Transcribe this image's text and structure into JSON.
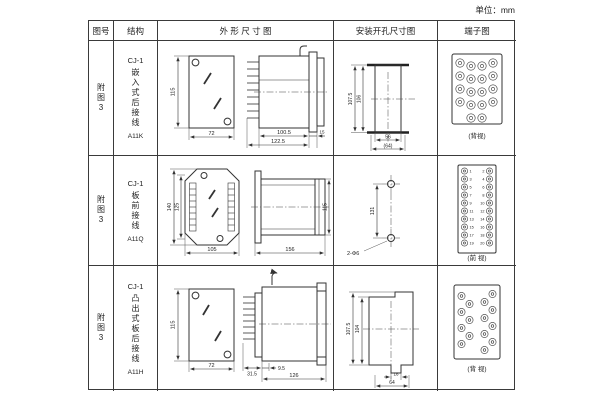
{
  "page": {
    "unit_label": "单位：mm"
  },
  "table": {
    "headers": {
      "fig_no": "图号",
      "structure": "结构",
      "outline": "外 形 尺 寸 图",
      "mounting": "安装开孔尺寸图",
      "terminal": "端子图"
    }
  },
  "rows": [
    {
      "fig": "附图3",
      "series": "CJ-1",
      "structure_name": "嵌入式后接线",
      "model_code": "A11K",
      "outline": {
        "front_h": "115",
        "front_w": "72",
        "depth": "100.5",
        "total": "122.5",
        "flange": "15"
      },
      "mounting": {
        "h_outer": "107.5",
        "h_inner": "106",
        "w_inner": "56",
        "w_outer": "(64)"
      },
      "terminal": {
        "caption": "(背视)"
      }
    },
    {
      "fig": "附图3",
      "series": "CJ-1",
      "structure_name": "板前接线",
      "model_code": "A11Q",
      "outline": {
        "front_h_outer": "140",
        "front_h_inner": "125",
        "front_w": "105",
        "side_len": "156",
        "side_h": "115"
      },
      "mounting": {
        "pitch": "131",
        "holes": "2-Φ6"
      },
      "terminal": {
        "caption": "(前 视)",
        "numbers": [
          "1",
          "2",
          "3",
          "4",
          "5",
          "6",
          "7",
          "8",
          "9",
          "10",
          "11",
          "12",
          "13",
          "14",
          "15",
          "16",
          "17",
          "18",
          "19",
          "20"
        ]
      }
    },
    {
      "fig": "附图3",
      "series": "CJ-1",
      "structure_name": "凸出式板后接线",
      "model_code": "A11H",
      "outline": {
        "front_h": "115",
        "front_w": "72",
        "pin_len": "31.5",
        "offset": "9.5",
        "body_len": "126"
      },
      "mounting": {
        "h_outer": "107.5",
        "h_inner": "104",
        "tab_w": "16",
        "w": "64"
      },
      "terminal": {
        "caption": "(背 视)"
      }
    }
  ]
}
